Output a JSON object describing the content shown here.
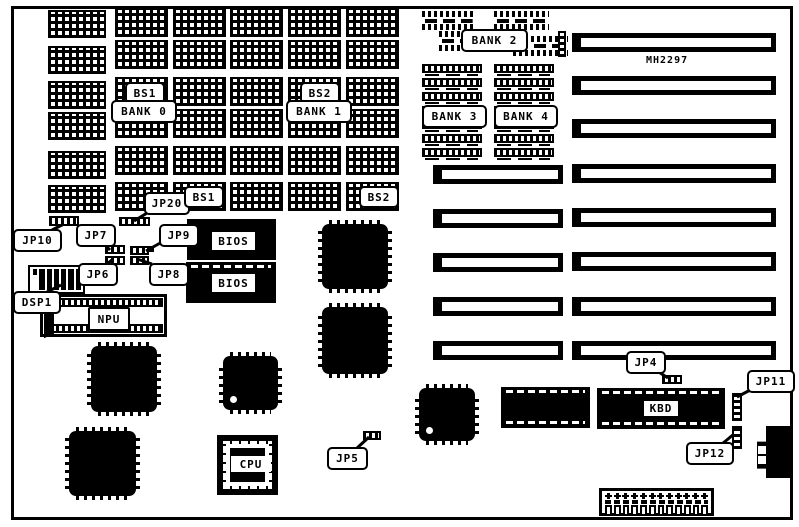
{
  "colors": {
    "ink": "#000000",
    "paper": "#ffffff"
  },
  "board": {
    "model_number": "MH2297",
    "memory_banks": {
      "bank0": "BANK 0",
      "bank1": "BANK 1",
      "bank2": "BANK 2",
      "bank3": "BANK 3",
      "bank4": "BANK 4"
    },
    "bank_select": {
      "bs1_top": "BS1",
      "bs2_top": "BS2",
      "bs1_bottom": "BS1",
      "bs2_bottom": "BS2"
    },
    "jumpers": {
      "jp4": "JP4",
      "jp5": "JP5",
      "jp6": "JP6",
      "jp7": "JP7",
      "jp8": "JP8",
      "jp9": "JP9",
      "jp10": "JP10",
      "jp11": "JP11",
      "jp12": "JP12",
      "jp20": "JP20"
    },
    "switches": {
      "dsp1": "DSP1"
    },
    "chips": {
      "bios_top": "BIOS",
      "bios_bottom": "BIOS",
      "npu": "NPU",
      "cpu": "CPU",
      "keyboard_controller": "KBD"
    }
  }
}
